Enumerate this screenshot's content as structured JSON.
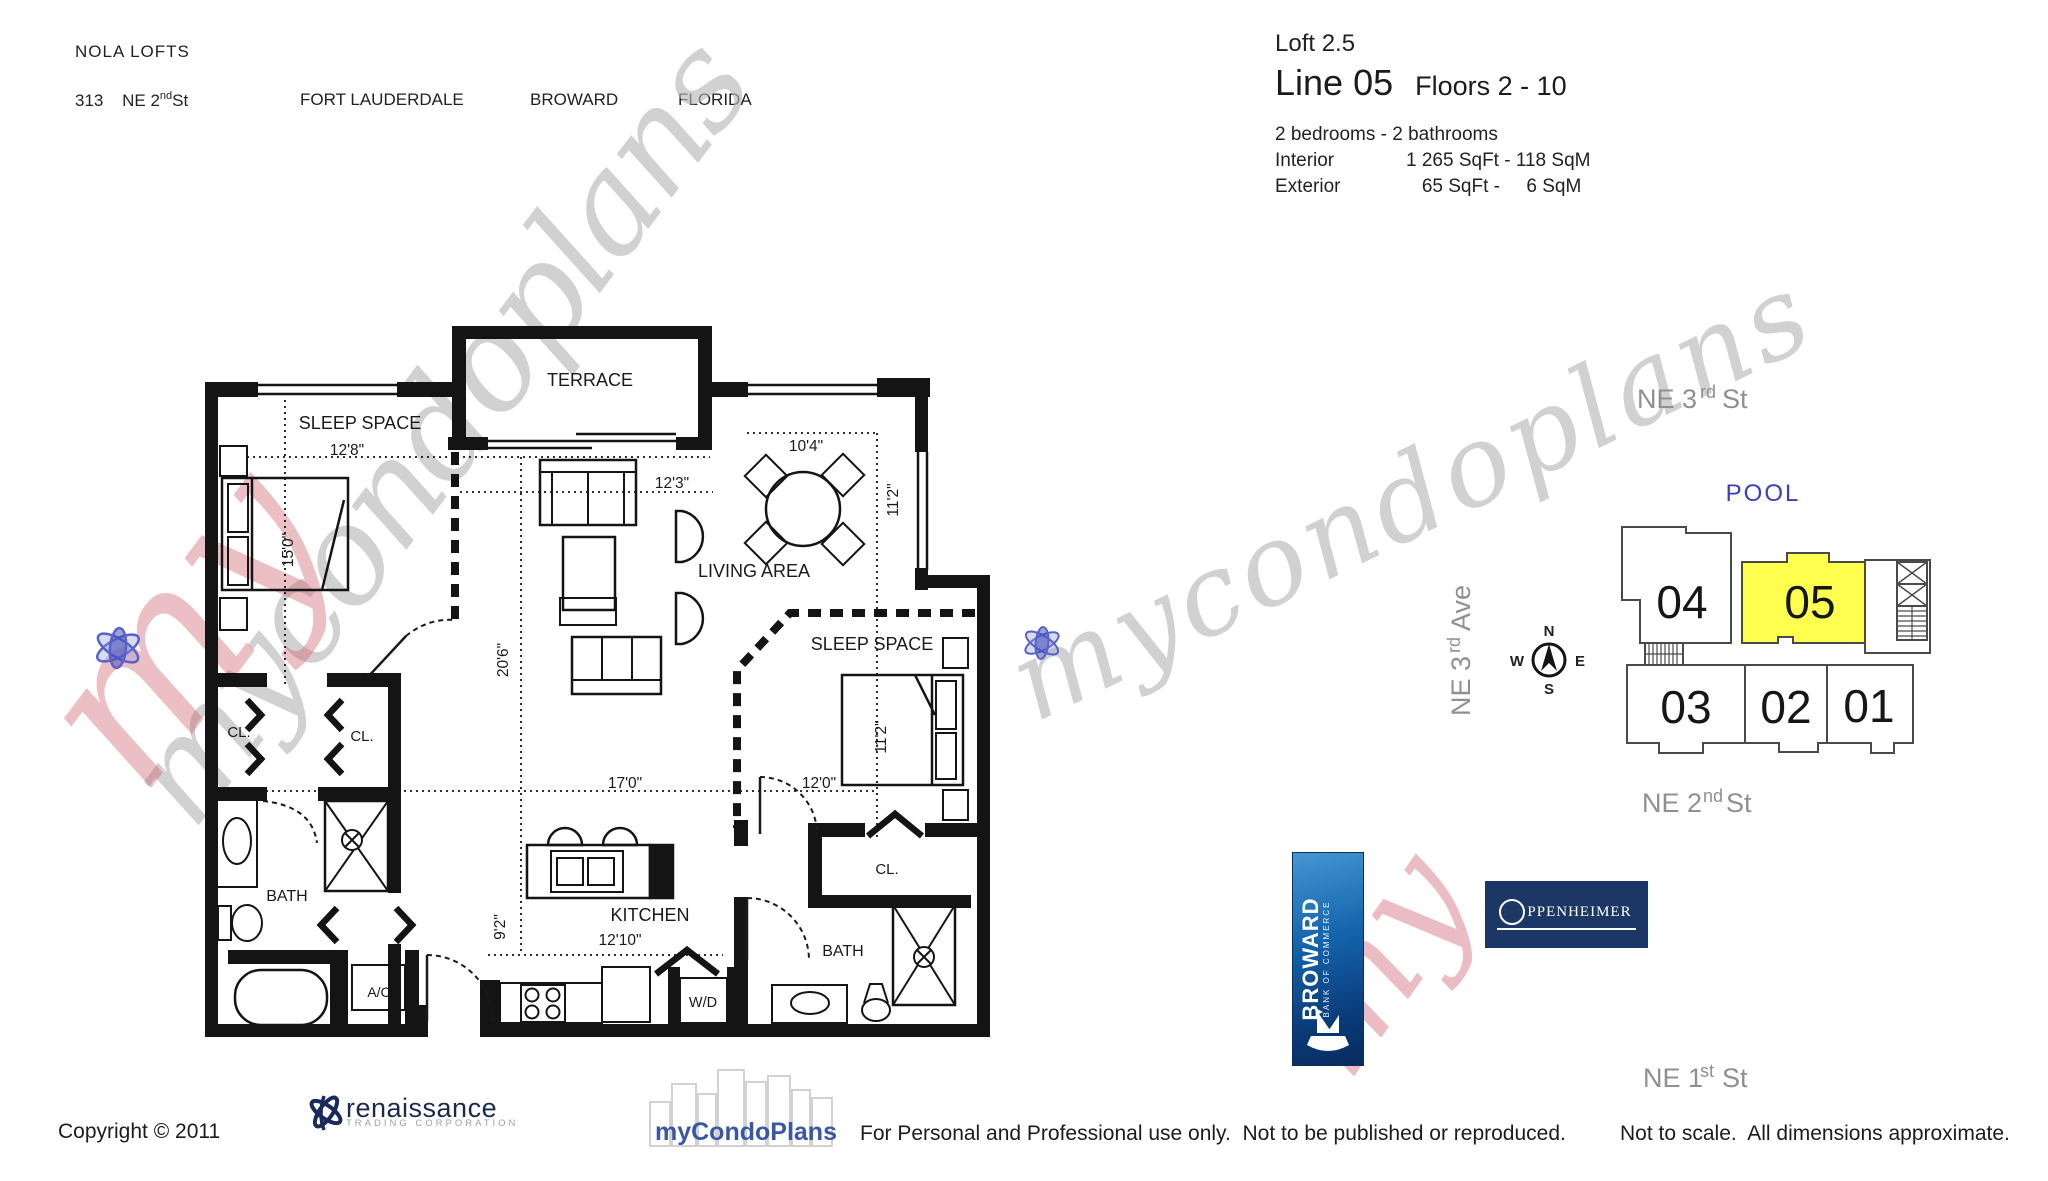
{
  "header": {
    "building_name": "NOLA LOFTS",
    "address_number": "313",
    "street_pre": "NE 2",
    "street_sup": "nd",
    "street_suf": " St",
    "city": "FORT LAUDERDALE",
    "county": "BROWARD",
    "state": "FLORIDA"
  },
  "unit_info": {
    "model": "Loft 2.5",
    "line": "Line 05",
    "floors": "Floors 2 - 10",
    "bed_bath": "2 bedrooms - 2 bathrooms",
    "interior_label": "Interior",
    "interior_value": "1 265 SqFt - 118 SqM",
    "exterior_label": "Exterior",
    "exterior_value": "   65 SqFt -     6 SqM"
  },
  "floor_plan": {
    "labels": {
      "terrace": "TERRACE",
      "sleep_space": "SLEEP SPACE",
      "living_area": "LIVING AREA",
      "kitchen": "KITCHEN",
      "bath": "BATH",
      "closet": "CL.",
      "ac": "A/C",
      "washer_dryer": "W/D"
    },
    "dims": {
      "d12_8": "12'8\"",
      "d15_0": "15'0\"",
      "d12_3": "12'3\"",
      "d10_4": "10'4\"",
      "d11_2": "11'2\"",
      "d20_6": "20'6\"",
      "d17_0": "17'0\"",
      "d12_0": "12'0\"",
      "d12_10": "12'10\"",
      "d9_2": "9'2\""
    }
  },
  "site_plan": {
    "pool": "POOL",
    "street_top_pre": "NE 3",
    "street_top_sup": "rd",
    "street_top_suf": " St",
    "ave_pre": "NE 3",
    "ave_sup": "rd",
    "ave_suf": " Ave",
    "street_mid_pre": "NE 2",
    "street_mid_sup": "nd",
    "street_mid_suf": " St",
    "street_bot_pre": "NE 1",
    "street_bot_sup": "st",
    "street_bot_suf": " St",
    "unit04": "04",
    "unit05": "05",
    "unit03": "03",
    "unit02": "02",
    "unit01": "01",
    "highlighted_unit": "05",
    "highlight_color": "#FFFF4F",
    "compass": {
      "n": "N",
      "e": "E",
      "s": "S",
      "w": "W"
    }
  },
  "logos": {
    "broward_name": "BROWARD",
    "broward_sub": "BANK OF COMMERCE",
    "oppenheimer_rest": "PPENHEIMER",
    "renaissance_name": "renaissance",
    "renaissance_sub": "TRADING CORPORATION",
    "mycondoplans": "myCondoPlans"
  },
  "footer": {
    "copyright": "Copyright © 2011",
    "usage": "For Personal and Professional use only.  Not to be published or reproduced.",
    "note": "Not to scale.  All dimensions approximate."
  },
  "watermark": {
    "script": "mycondoplans",
    "my": "my"
  }
}
